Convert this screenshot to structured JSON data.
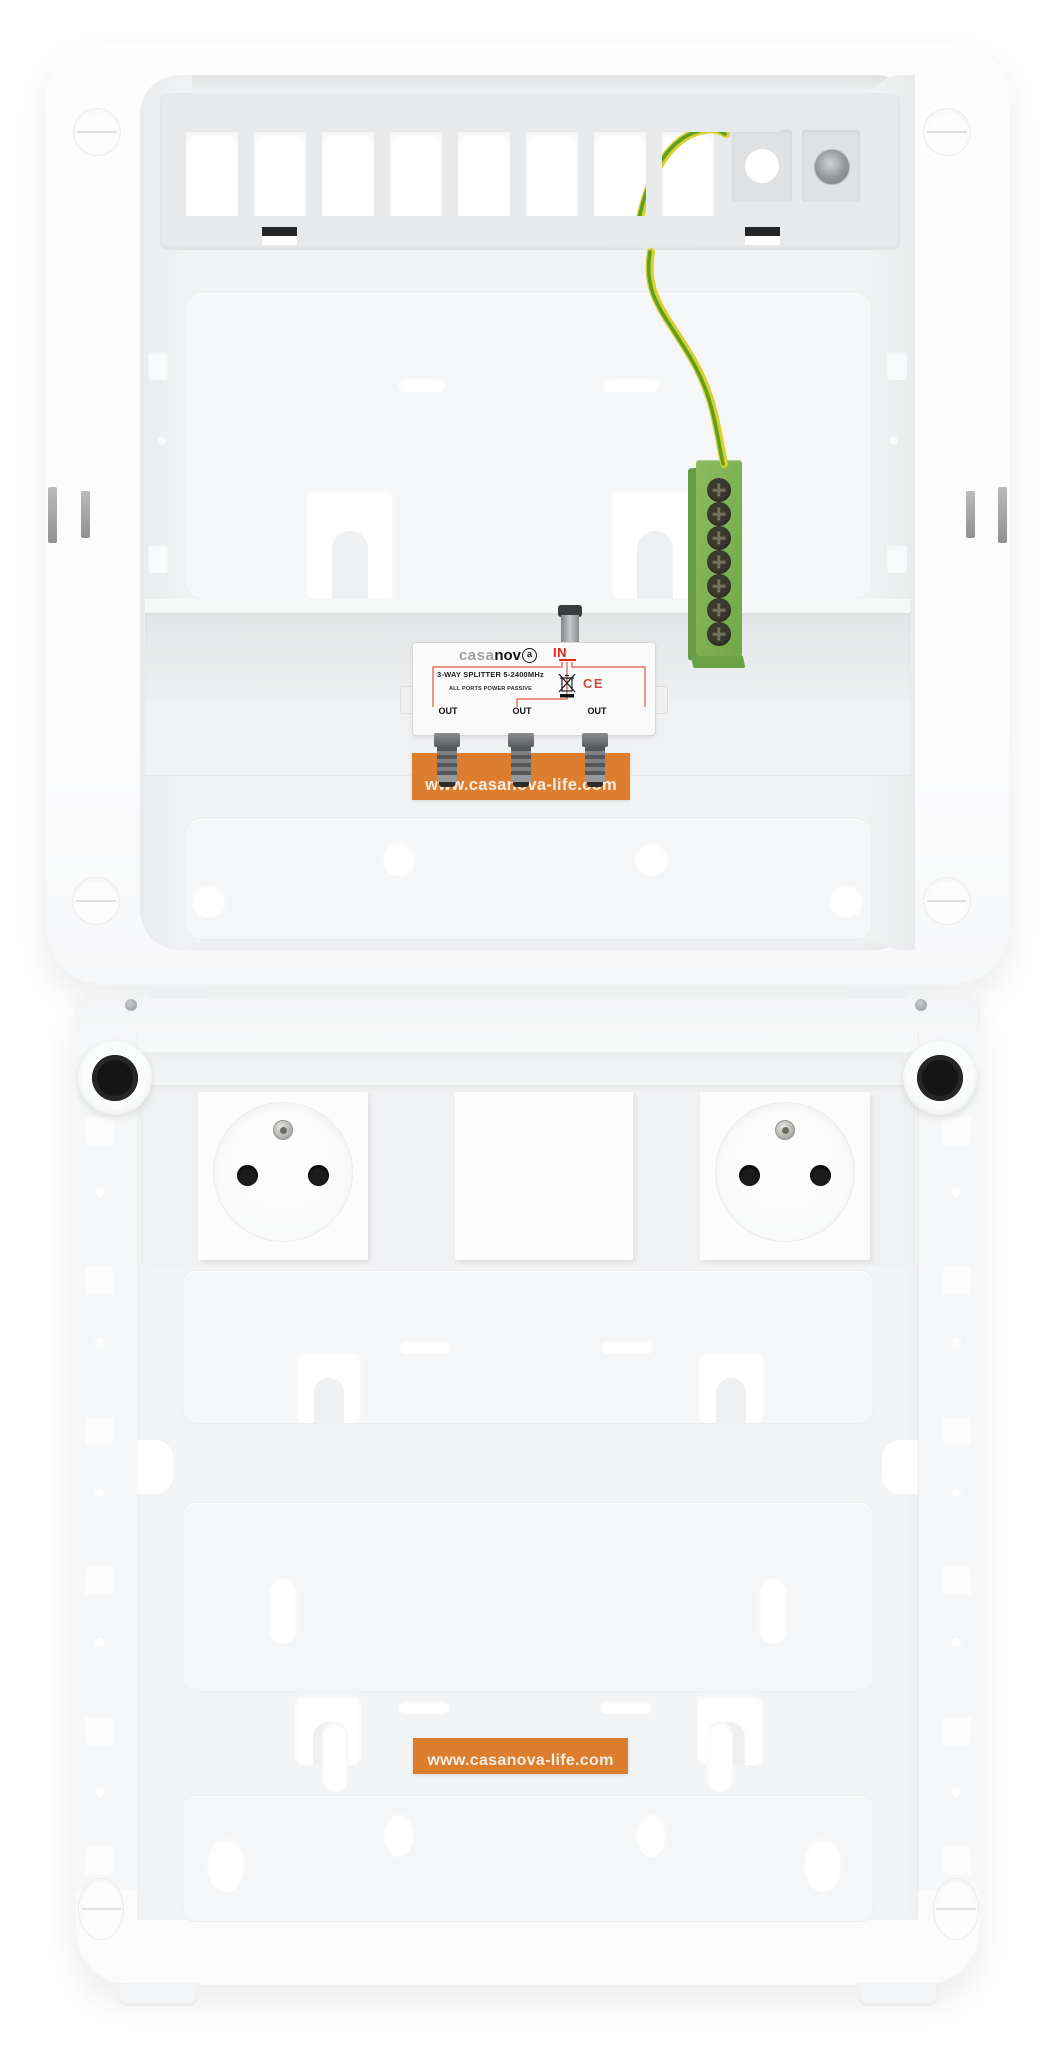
{
  "scene": {
    "description": "Flush-mount multimedia distribution enclosure, two stacked units, open without covers"
  },
  "top_unit": {
    "splitter": {
      "brand_prefix": "casa",
      "brand_mid": "nov",
      "brand_suffix": "a",
      "port_in_label": "IN",
      "spec_line": "3-WAY SPLITTER  5-2400MHz",
      "passive_line": "ALL PORTS POWER PASSIVE",
      "ce_mark": "CE",
      "out_labels": [
        "OUT",
        "OUT",
        "OUT"
      ]
    },
    "website_label": "www.casanova-life.com",
    "earth_terminal": {
      "screw_count": 7
    }
  },
  "bottom_unit": {
    "website_label": "www.casanova-life.com",
    "socket_count": 2
  },
  "colors": {
    "label_orange": "#dc7e2e",
    "terminal_green": "#7fb254",
    "wire_yellow": "#d8d02c",
    "wire_green": "#5f9d23",
    "accent_red": "#e02414"
  }
}
